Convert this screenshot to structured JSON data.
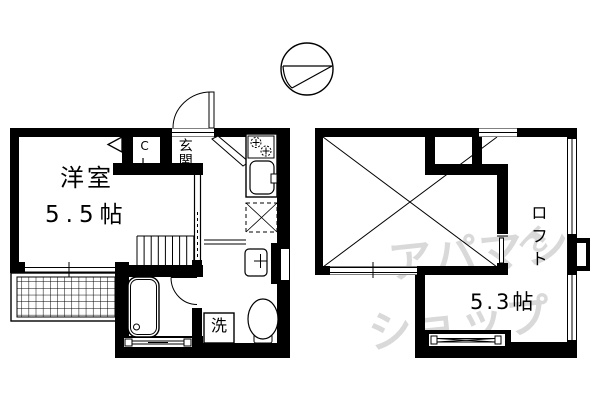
{
  "floor1": {
    "room_label": "洋室",
    "room_size": "5.5帖",
    "closet_label": "CL",
    "entrance_label": "玄関",
    "washer_label": "洗"
  },
  "loft": {
    "loft_label": "ロフト",
    "loft_size": "5.3帖"
  },
  "watermark": {
    "line1": "アパマン",
    "line2": "ショップ",
    "mark": "ん"
  },
  "colors": {
    "line": "#000000",
    "background": "#ffffff",
    "watermark": "#d9d9d9"
  }
}
